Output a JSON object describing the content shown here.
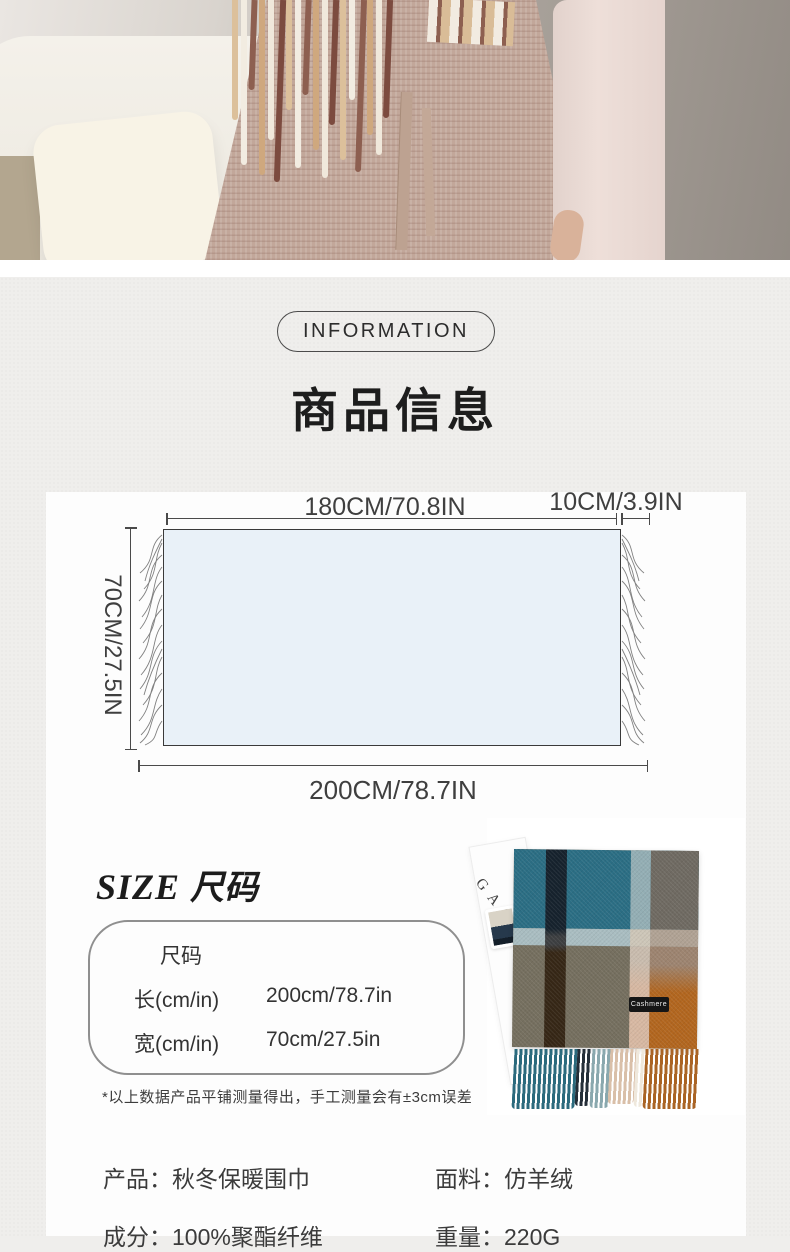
{
  "colors": {
    "page_bg": "#efeeec",
    "card_bg": "#fdfdfd",
    "diagram_fill": "#e9f1f8",
    "scarf_teal": "#2b6e84",
    "scarf_navy": "#16222d",
    "scarf_grey": "#756f5f",
    "scarf_orange": "#b2661f",
    "scarf_tan": "#d7b8a2"
  },
  "badge": {
    "label": "INFORMATION"
  },
  "section": {
    "title": "商品信息"
  },
  "diagram": {
    "top_width": "180CM/70.8IN",
    "tassel_width": "10CM/3.9IN",
    "side_height": "70CM/27.5IN",
    "total_length": "200CM/78.7IN"
  },
  "size": {
    "heading_en": "SIZE",
    "heading_cn": "尺码",
    "box": {
      "header": "尺码",
      "rows": [
        {
          "label": "长(cm/in)",
          "value": "200cm/78.7in"
        },
        {
          "label": "宽(cm/in)",
          "value": "70cm/27.5in"
        }
      ]
    },
    "note": "*以上数据产品平铺测量得出，手工测量会有±3cm误差"
  },
  "photo": {
    "card_letters": "GAR",
    "tag_label": "Cashmere"
  },
  "attributes": {
    "items": [
      "产品：秋冬保暖围巾",
      "面料：仿羊绒",
      "成分：100%聚酯纤维",
      "重量：220G"
    ]
  }
}
